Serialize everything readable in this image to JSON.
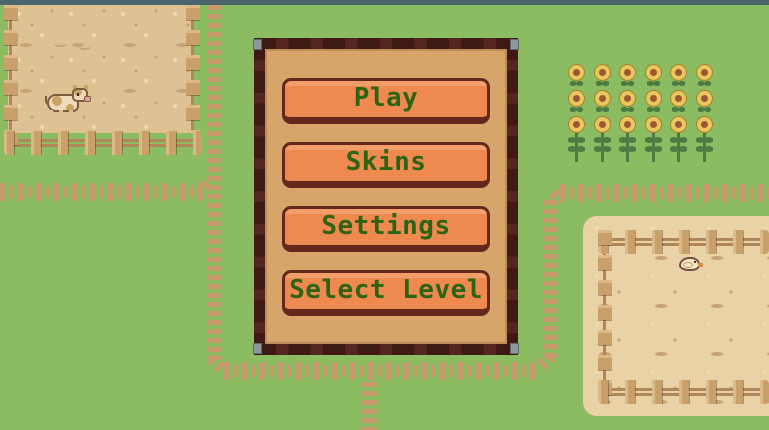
{
  "menu": {
    "buttons": [
      {
        "id": "play",
        "label": "Play"
      },
      {
        "id": "skins",
        "label": "Skins"
      },
      {
        "id": "settings",
        "label": "Settings"
      },
      {
        "id": "select-level",
        "label": "Select Level"
      }
    ]
  },
  "background": {
    "sunflowers": {
      "rows": 3,
      "cols": 6
    },
    "animals": [
      {
        "name": "cow",
        "location": "top-left-pen"
      },
      {
        "name": "chick",
        "location": "bottom-right-pen"
      }
    ]
  },
  "colors": {
    "grass": "#8cbc61",
    "top_strip": "#4b656e",
    "path": "#c89b6e",
    "pen_dirt": "#dec293",
    "pen_sand": "#e9d3a6",
    "speckle_light": "#eedcb0",
    "speckle_dark": "#c7a377",
    "fence": "#c9a069",
    "fence_light": "#dcb988",
    "rail": "#b08758",
    "outline_brown": "#7d5c3c",
    "panel_border": "#542620",
    "panel_dash": "#35130d",
    "panel_fill": "#d7a569",
    "rivet": "#8e999b",
    "button_fill": "#ee8a4f",
    "button_light": "#f29e68",
    "button_border": "#63271c",
    "button_text": "#2c6414",
    "petal": "#e7c75e",
    "petal_edge": "#a97f2e",
    "flower_center": "#9d5733",
    "stem": "#4d7c43",
    "cow_body": "#ecdcba",
    "cow_patch": "#c9a264",
    "cow_leg": "#d8c09a",
    "snout": "#e7a0a5",
    "chick_body": "#f3ebc0",
    "chick_outline": "#7b4b41",
    "beak": "#d98c3f"
  }
}
